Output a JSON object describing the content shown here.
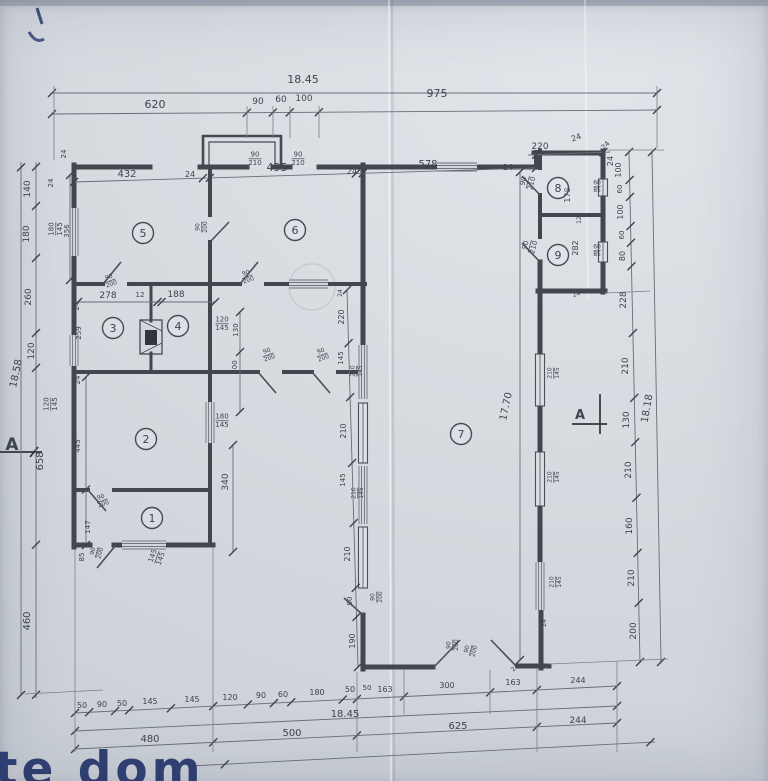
{
  "drawing": {
    "type": "floor-plan",
    "totals": {
      "top": "18.45",
      "bottom": "18.45",
      "left": "18.58",
      "right": "18.18",
      "inner_height": "17.70"
    },
    "watermark": {
      "text": "te dom",
      "color": "#25356b"
    },
    "section_markers": [
      {
        "label": "A",
        "x": 12,
        "y": 450,
        "fs": 17
      },
      {
        "label": "A",
        "x": 580,
        "y": 419,
        "fs": 13
      }
    ],
    "rooms": [
      {
        "n": "1",
        "x": 152,
        "y": 518
      },
      {
        "n": "2",
        "x": 146,
        "y": 439
      },
      {
        "n": "3",
        "x": 113,
        "y": 328
      },
      {
        "n": "4",
        "x": 178,
        "y": 326
      },
      {
        "n": "5",
        "x": 143,
        "y": 233
      },
      {
        "n": "6",
        "x": 295,
        "y": 230
      },
      {
        "n": "7",
        "x": 461,
        "y": 434
      },
      {
        "n": "8",
        "x": 558,
        "y": 188
      },
      {
        "n": "9",
        "x": 558,
        "y": 255
      }
    ],
    "labels": [
      {
        "t": "18.45",
        "x": 303,
        "y": 83,
        "fs": 11
      },
      {
        "t": "620",
        "x": 155,
        "y": 108,
        "fs": 11
      },
      {
        "t": "90",
        "x": 258,
        "y": 104,
        "fs": 9
      },
      {
        "t": "60",
        "x": 281,
        "y": 102,
        "fs": 9
      },
      {
        "t": "100",
        "x": 304,
        "y": 101,
        "fs": 9
      },
      {
        "t": "975",
        "x": 437,
        "y": 97,
        "fs": 11
      },
      {
        "t": "432",
        "x": 127,
        "y": 177,
        "fs": 10
      },
      {
        "t": "24",
        "x": 190,
        "y": 177,
        "fs": 8
      },
      {
        "t": "495",
        "x": 277,
        "y": 171,
        "fs": 11
      },
      {
        "t": "24",
        "x": 352,
        "y": 174,
        "fs": 8
      },
      {
        "t": "578",
        "x": 428,
        "y": 167,
        "fs": 10
      },
      {
        "t": "24",
        "x": 508,
        "y": 170,
        "fs": 8
      },
      {
        "t": "220",
        "x": 540,
        "y": 149,
        "fs": 9
      },
      {
        "t": "24",
        "x": 577,
        "y": 140,
        "fs": 8,
        "r": -20
      },
      {
        "t": "24",
        "x": 613,
        "y": 161,
        "fs": 8,
        "r": -90
      },
      {
        "t": "90",
        "t2": "210",
        "x": 255,
        "y": 158,
        "fs": 7
      },
      {
        "t": "90",
        "t2": "210",
        "x": 298,
        "y": 158,
        "fs": 7
      },
      {
        "t": "90",
        "t2": "210",
        "x": 527,
        "y": 182,
        "fs": 7,
        "r": -75
      },
      {
        "t": "90",
        "t2": "210",
        "x": 529,
        "y": 246,
        "fs": 7,
        "r": -75
      },
      {
        "t": "140",
        "x": 30,
        "y": 189,
        "fs": 9,
        "r": -90
      },
      {
        "t": "180",
        "x": 29,
        "y": 234,
        "fs": 9,
        "r": -90
      },
      {
        "t": "260",
        "x": 31,
        "y": 297,
        "fs": 9,
        "r": -90
      },
      {
        "t": "120",
        "x": 34,
        "y": 351,
        "fs": 9,
        "r": -90
      },
      {
        "t": "658",
        "x": 43,
        "y": 461,
        "fs": 10,
        "r": -90
      },
      {
        "t": "460",
        "x": 30,
        "y": 621,
        "fs": 10,
        "r": -90
      },
      {
        "t": "18.58",
        "x": 19,
        "y": 374,
        "fs": 10,
        "r": -78
      },
      {
        "t": "24",
        "x": 53,
        "y": 183,
        "fs": 7,
        "r": -90
      },
      {
        "t": "24",
        "x": 66,
        "y": 154,
        "fs": 7,
        "r": -90
      },
      {
        "t": "180",
        "t2": "145",
        "x": 55,
        "y": 229,
        "fs": 7,
        "r": -90
      },
      {
        "t": "120",
        "t2": "145",
        "x": 50,
        "y": 404,
        "fs": 7,
        "r": -90
      },
      {
        "t": "356",
        "x": 69,
        "y": 231,
        "fs": 7,
        "r": -90
      },
      {
        "t": "259",
        "x": 81,
        "y": 333,
        "fs": 7,
        "r": -90
      },
      {
        "t": "24",
        "x": 79,
        "y": 306,
        "fs": 7,
        "r": -90
      },
      {
        "t": "445",
        "x": 80,
        "y": 446,
        "fs": 7,
        "r": -90
      },
      {
        "t": "24",
        "x": 80,
        "y": 380,
        "fs": 7,
        "r": -90
      },
      {
        "t": "147",
        "x": 90,
        "y": 527,
        "fs": 7,
        "r": -90
      },
      {
        "t": "85",
        "x": 84,
        "y": 557,
        "fs": 7,
        "r": -90
      },
      {
        "t": "278",
        "x": 108,
        "y": 298,
        "fs": 9
      },
      {
        "t": "12",
        "x": 140,
        "y": 297,
        "fs": 7
      },
      {
        "t": "188",
        "x": 176,
        "y": 297,
        "fs": 9
      },
      {
        "t": "90",
        "t2": "200",
        "x": 110,
        "y": 280,
        "fs": 6,
        "r": -20
      },
      {
        "t": "90",
        "t2": "200",
        "x": 201,
        "y": 227,
        "fs": 6,
        "r": -90
      },
      {
        "t": "90",
        "t2": "200",
        "x": 247,
        "y": 276,
        "fs": 6,
        "r": -20
      },
      {
        "t": "120",
        "t2": "145",
        "x": 222,
        "y": 323,
        "fs": 7
      },
      {
        "t": "130",
        "x": 238,
        "y": 330,
        "fs": 7,
        "r": -90
      },
      {
        "t": "200",
        "x": 237,
        "y": 367,
        "fs": 7,
        "r": -90
      },
      {
        "t": "90",
        "t2": "200",
        "x": 268,
        "y": 354,
        "fs": 6,
        "r": -20
      },
      {
        "t": "90",
        "t2": "200",
        "x": 322,
        "y": 354,
        "fs": 6,
        "r": -20
      },
      {
        "t": "180",
        "t2": "145",
        "x": 222,
        "y": 420,
        "fs": 7
      },
      {
        "t": "340",
        "x": 228,
        "y": 482,
        "fs": 9,
        "r": -90
      },
      {
        "t": "90",
        "t2": "200",
        "x": 102,
        "y": 500,
        "fs": 6,
        "r": -20
      },
      {
        "t": "90",
        "t2": "200",
        "x": 96,
        "y": 552,
        "fs": 6,
        "r": -75
      },
      {
        "t": "145",
        "t2": "145",
        "x": 156,
        "y": 557,
        "fs": 7,
        "r": -70
      },
      {
        "t": "24",
        "x": 342,
        "y": 293,
        "fs": 6,
        "r": -90
      },
      {
        "t": "220",
        "x": 344,
        "y": 317,
        "fs": 8,
        "r": -90
      },
      {
        "t": "145",
        "x": 343,
        "y": 358,
        "fs": 7,
        "r": -90
      },
      {
        "t": "210",
        "t2": "145",
        "x": 356,
        "y": 371,
        "fs": 6,
        "r": -90
      },
      {
        "t": "210",
        "x": 346,
        "y": 431,
        "fs": 8,
        "r": -90
      },
      {
        "t": "145",
        "x": 345,
        "y": 480,
        "fs": 7,
        "r": -90
      },
      {
        "t": "210",
        "t2": "145",
        "x": 357,
        "y": 493,
        "fs": 6,
        "r": -90
      },
      {
        "t": "210",
        "x": 350,
        "y": 554,
        "fs": 8,
        "r": -90
      },
      {
        "t": "90",
        "x": 352,
        "y": 601,
        "fs": 7,
        "r": -90
      },
      {
        "t": "90",
        "t2": "200",
        "x": 376,
        "y": 597,
        "fs": 6,
        "r": -90
      },
      {
        "t": "190",
        "x": 355,
        "y": 641,
        "fs": 8,
        "r": -90
      },
      {
        "t": "50",
        "x": 367,
        "y": 690,
        "fs": 7
      },
      {
        "t": "210",
        "t2": "145",
        "x": 553,
        "y": 373,
        "fs": 6,
        "r": -90
      },
      {
        "t": "210",
        "t2": "145",
        "x": 553,
        "y": 477,
        "fs": 6,
        "r": -90
      },
      {
        "t": "210",
        "t2": "145",
        "x": 555,
        "y": 582,
        "fs": 6,
        "r": -90
      },
      {
        "t": "24",
        "x": 546,
        "y": 623,
        "fs": 6,
        "r": -90
      },
      {
        "t": "24",
        "x": 577,
        "y": 296,
        "fs": 6,
        "r": -20
      },
      {
        "t": "178",
        "x": 570,
        "y": 195,
        "fs": 8,
        "r": -90
      },
      {
        "t": "12",
        "x": 581,
        "y": 220,
        "fs": 6,
        "r": -90
      },
      {
        "t": "282",
        "x": 578,
        "y": 248,
        "fs": 8,
        "r": -90
      },
      {
        "t": "60",
        "t2": "85",
        "x": 597,
        "y": 186,
        "fs": 6
      },
      {
        "t": "60",
        "t2": "85",
        "x": 597,
        "y": 250,
        "fs": 6
      },
      {
        "t": "100",
        "x": 621,
        "y": 170,
        "fs": 8,
        "r": -90
      },
      {
        "t": "60",
        "x": 622,
        "y": 189,
        "fs": 7,
        "r": -90
      },
      {
        "t": "100",
        "x": 623,
        "y": 212,
        "fs": 8,
        "r": -90
      },
      {
        "t": "60",
        "x": 624,
        "y": 235,
        "fs": 7,
        "r": -90
      },
      {
        "t": "80",
        "x": 625,
        "y": 256,
        "fs": 8,
        "r": -90
      },
      {
        "t": "228",
        "x": 626,
        "y": 300,
        "fs": 9,
        "r": -90
      },
      {
        "t": "210",
        "x": 628,
        "y": 366,
        "fs": 9,
        "r": -90
      },
      {
        "t": "130",
        "x": 629,
        "y": 420,
        "fs": 9,
        "r": -90
      },
      {
        "t": "210",
        "x": 631,
        "y": 470,
        "fs": 9,
        "r": -90
      },
      {
        "t": "160",
        "x": 632,
        "y": 526,
        "fs": 9,
        "r": -90
      },
      {
        "t": "210",
        "x": 634,
        "y": 578,
        "fs": 9,
        "r": -90
      },
      {
        "t": "200",
        "x": 636,
        "y": 631,
        "fs": 9,
        "r": -90
      },
      {
        "t": "18.18",
        "x": 650,
        "y": 409,
        "fs": 10,
        "r": -80
      },
      {
        "t": "17.70",
        "x": 509,
        "y": 407,
        "fs": 10,
        "r": -78
      },
      {
        "t": "24",
        "x": 607,
        "y": 147,
        "fs": 7,
        "r": -45
      },
      {
        "t": "50",
        "x": 82,
        "y": 708,
        "fs": 8
      },
      {
        "t": "90",
        "x": 102,
        "y": 707,
        "fs": 8
      },
      {
        "t": "50",
        "x": 122,
        "y": 706,
        "fs": 8
      },
      {
        "t": "145",
        "x": 150,
        "y": 704,
        "fs": 8
      },
      {
        "t": "145",
        "x": 192,
        "y": 702,
        "fs": 8
      },
      {
        "t": "120",
        "x": 230,
        "y": 700,
        "fs": 8
      },
      {
        "t": "90",
        "x": 261,
        "y": 698,
        "fs": 8
      },
      {
        "t": "60",
        "x": 283,
        "y": 697,
        "fs": 8
      },
      {
        "t": "180",
        "x": 317,
        "y": 695,
        "fs": 8
      },
      {
        "t": "50",
        "x": 350,
        "y": 692,
        "fs": 8
      },
      {
        "t": "163",
        "x": 385,
        "y": 692,
        "fs": 8
      },
      {
        "t": "300",
        "x": 447,
        "y": 688,
        "fs": 8
      },
      {
        "t": "163",
        "x": 513,
        "y": 685,
        "fs": 8
      },
      {
        "t": "244",
        "x": 578,
        "y": 683,
        "fs": 8
      },
      {
        "t": "18.45",
        "x": 345,
        "y": 717,
        "fs": 10
      },
      {
        "t": "480",
        "x": 150,
        "y": 742,
        "fs": 10
      },
      {
        "t": "500",
        "x": 292,
        "y": 736,
        "fs": 10
      },
      {
        "t": "625",
        "x": 458,
        "y": 729,
        "fs": 10
      },
      {
        "t": "244",
        "x": 578,
        "y": 723,
        "fs": 9
      },
      {
        "t": "90",
        "t2": "200",
        "x": 452,
        "y": 645,
        "fs": 6,
        "r": -90
      },
      {
        "t": "90",
        "t2": "200",
        "x": 470,
        "y": 650,
        "fs": 6,
        "r": -75
      },
      {
        "t": "24",
        "x": 516,
        "y": 669,
        "fs": 6,
        "r": -45
      }
    ]
  }
}
